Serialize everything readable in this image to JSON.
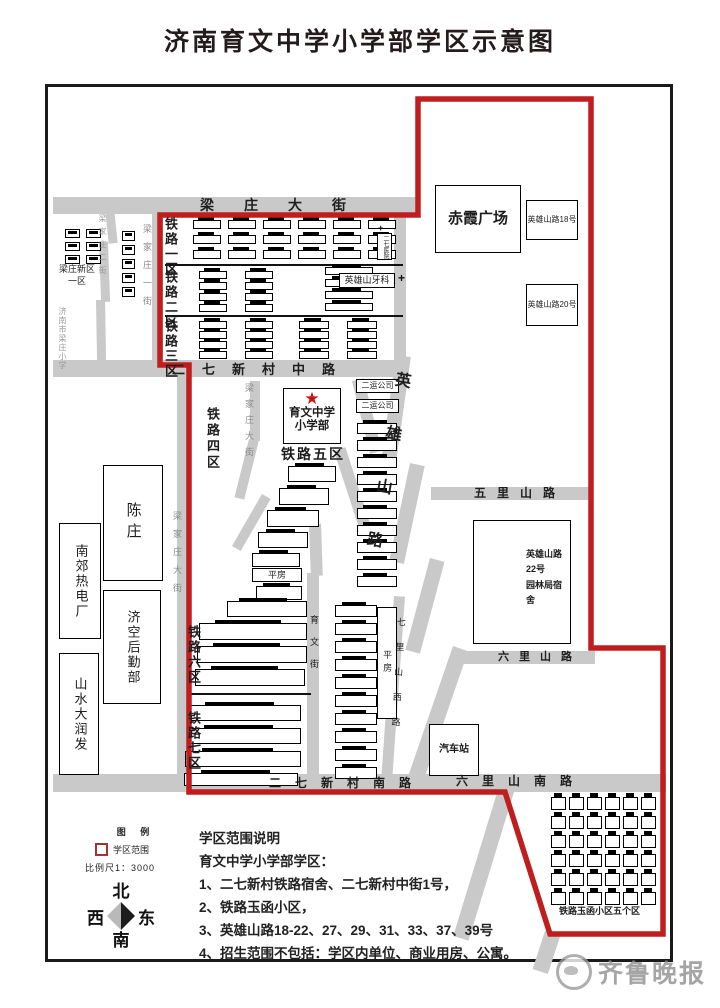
{
  "title": "济南育文中学小学部学区示意图",
  "watermark": {
    "brand": "齐鲁晚报"
  },
  "legend": {
    "heading": "图 例",
    "district_symbol_label": "学区范围",
    "scale": "比例尺1：3000"
  },
  "compass": {
    "north": "北",
    "south": "南",
    "east": "东",
    "west": "西"
  },
  "notes": {
    "heading": "学区范围说明",
    "subheading": "育文中学小学部学区：",
    "items": [
      "1、二七新村铁路宿舍、二七新村中街1号，",
      "2、铁路玉函小区，",
      "3、英雄山路18-22、27、29、31、33、37、39号",
      "4、招生范围不包括：学区内单位、商业用房、公寓。"
    ]
  },
  "colors": {
    "boundary": "#c01e1e",
    "road": "#c9c9c9",
    "star": "#cc1111"
  },
  "map": {
    "school": {
      "line1": "育文中学",
      "line2": "小学部",
      "district_label": "铁路五区",
      "star": "★"
    },
    "streets": [
      {
        "id": "liangzhuang-dajie",
        "text": "梁庄大街"
      },
      {
        "id": "erqi-xincun-zhonglu",
        "text": "二七新村中路"
      },
      {
        "id": "erqi-xincun-nanlu",
        "text": "二七新村南路"
      },
      {
        "id": "liuli-shan-nanlu",
        "text": "六里山南路"
      },
      {
        "id": "wuli-shanlu",
        "text": "五里山路"
      },
      {
        "id": "liuli-shanlu",
        "text": "六里山路"
      },
      {
        "id": "yingxiong-shanlu",
        "text": "英雄山路"
      },
      {
        "id": "qili-shan-xilu",
        "text": "七里山西路"
      },
      {
        "id": "yuwen-jie",
        "text": "育文街"
      },
      {
        "id": "liangjiazhuang-dajie-north",
        "text": "梁家庄大街"
      },
      {
        "id": "liangjiazhuang-dajie-south",
        "text": "梁家庄大街"
      },
      {
        "id": "liangjiazhuang-yijie",
        "text": "梁家庄一街"
      },
      {
        "id": "liangjiazhuang-erjie",
        "text": "梁家庄二街"
      },
      {
        "id": "jinan-liangzhuang-xiaoxue",
        "text": "济南市梁庄小学"
      }
    ],
    "zones": [
      {
        "id": "tielu-1",
        "text": "铁路一区"
      },
      {
        "id": "tielu-2",
        "text": "铁路二区"
      },
      {
        "id": "tielu-3",
        "text": "铁路三区"
      },
      {
        "id": "tielu-4",
        "text": "铁路四区"
      },
      {
        "id": "tielu-6",
        "text": "铁路六区"
      },
      {
        "id": "tielu-7",
        "text": "铁路七区"
      },
      {
        "id": "liangzhuang-xinqu",
        "lines": [
          "梁庄新区",
          "一区"
        ]
      },
      {
        "id": "yuhan-caption",
        "text": "铁路玉函小区五个区"
      }
    ],
    "places": [
      {
        "id": "chixia-guangchang",
        "text": "赤霞广场"
      },
      {
        "id": "yingxiongshan-lu-18",
        "text": "英雄山路18号"
      },
      {
        "id": "yingxiongshan-lu-20",
        "text": "英雄山路20号"
      },
      {
        "id": "yingxiongshan-yake",
        "text": "英雄山牙科"
      },
      {
        "id": "erqi-yiyuan",
        "text": "二七医院"
      },
      {
        "id": "eryun-gongsi-1",
        "text": "二运公司"
      },
      {
        "id": "eryun-gongsi-2",
        "text": "二运公司"
      },
      {
        "id": "yuanlinju",
        "lines": [
          "英雄山路22号",
          "园林局宿舍"
        ]
      },
      {
        "id": "qichezhan",
        "text": "汽车站"
      },
      {
        "id": "pingfang-west",
        "text": "平房"
      },
      {
        "id": "pingfang-east",
        "text": "平房"
      },
      {
        "id": "chenzhuang",
        "text": "陈庄"
      },
      {
        "id": "nanjiao-redianchang",
        "text": "南郊热电厂"
      },
      {
        "id": "jikong-houqinbu",
        "text": "济空后勤部"
      },
      {
        "id": "shanshui-darunfa",
        "text": "山水大润发"
      }
    ]
  }
}
